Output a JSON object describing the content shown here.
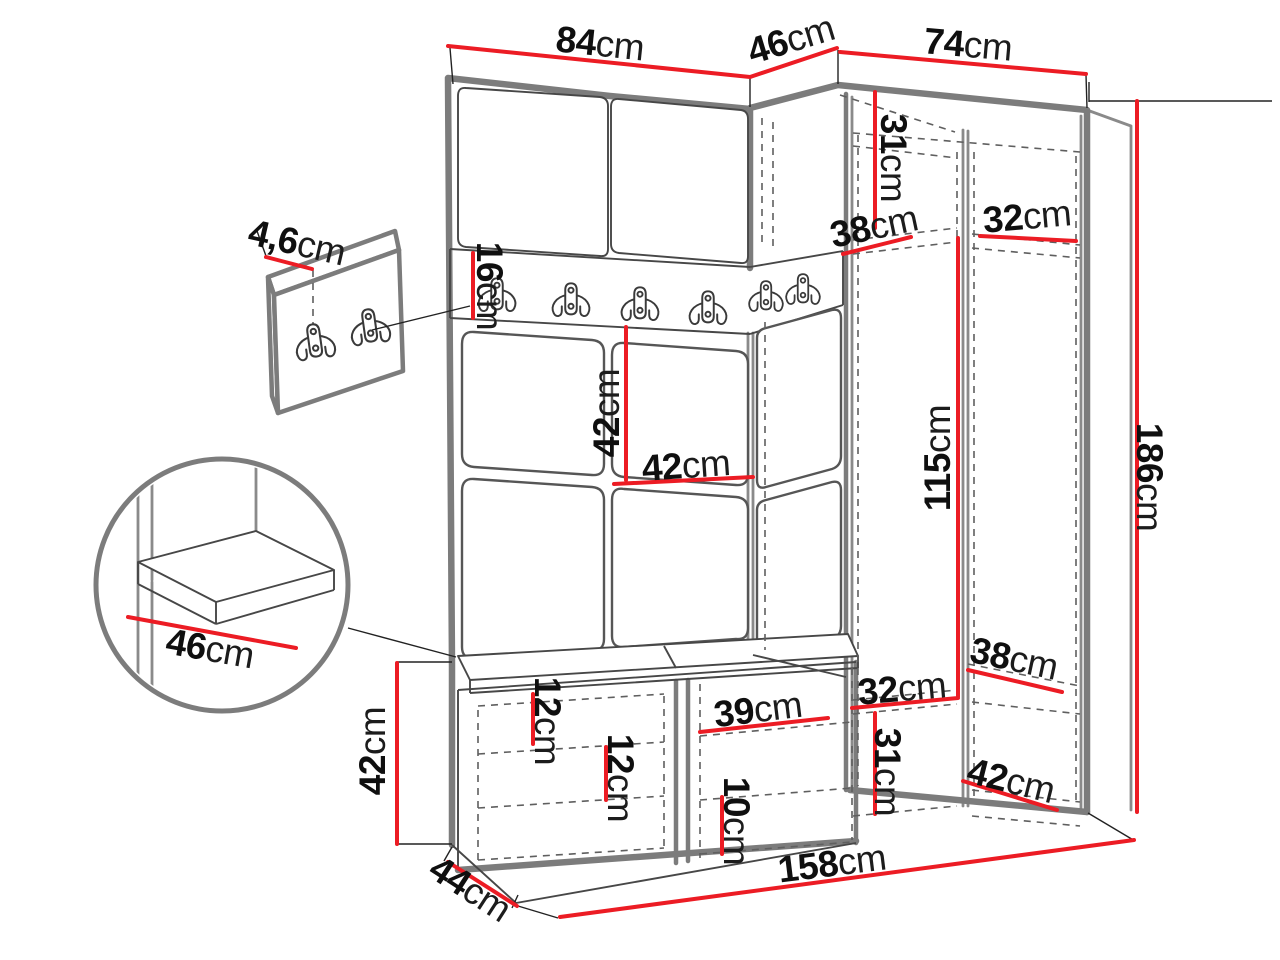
{
  "figure": {
    "type": "furniture-dimension-diagram",
    "subject": "hallway wardrobe set with coat hooks, corner wardrobe and shoe bench",
    "measurement_unit": "cm"
  },
  "colors": {
    "dimension_line": "#ec1c24",
    "outline_grey": "#7c7c7c",
    "text": "#0f0f0f",
    "background": "#ffffff"
  },
  "labels": [
    {
      "id": "top-width-left",
      "value": "84",
      "unit": "cm"
    },
    {
      "id": "top-width-corner",
      "value": "46",
      "unit": "cm"
    },
    {
      "id": "top-width-right",
      "value": "74",
      "unit": "cm"
    },
    {
      "id": "upper-compartment-height",
      "value": "31",
      "unit": "cm"
    },
    {
      "id": "upper-shelf-depth",
      "value": "38",
      "unit": "cm"
    },
    {
      "id": "upper-shelf-width-right",
      "value": "32",
      "unit": "cm"
    },
    {
      "id": "hook-rail-height",
      "value": "16",
      "unit": "cm"
    },
    {
      "id": "wall-panel-thickness",
      "value": "4,6",
      "unit": "cm"
    },
    {
      "id": "back-panel-height",
      "value": "42",
      "unit": "cm"
    },
    {
      "id": "back-panel-width",
      "value": "42",
      "unit": "cm"
    },
    {
      "id": "hanging-space-height",
      "value": "115",
      "unit": "cm"
    },
    {
      "id": "total-height",
      "value": "186",
      "unit": "cm"
    },
    {
      "id": "seat-depth-detail",
      "value": "46",
      "unit": "cm"
    },
    {
      "id": "lower-shelf-width-left",
      "value": "32",
      "unit": "cm"
    },
    {
      "id": "lower-shelf-depth",
      "value": "38",
      "unit": "cm"
    },
    {
      "id": "bench-height",
      "value": "42",
      "unit": "cm"
    },
    {
      "id": "bench-shelf-gap-a",
      "value": "12",
      "unit": "cm"
    },
    {
      "id": "bench-compartment-width",
      "value": "39",
      "unit": "cm"
    },
    {
      "id": "bench-shelf-gap-b",
      "value": "12",
      "unit": "cm"
    },
    {
      "id": "lower-compartment-height",
      "value": "31",
      "unit": "cm"
    },
    {
      "id": "bench-shelf-height",
      "value": "10",
      "unit": "cm"
    },
    {
      "id": "lower-shelf-width-right",
      "value": "42",
      "unit": "cm"
    },
    {
      "id": "bench-depth",
      "value": "44",
      "unit": "cm"
    },
    {
      "id": "total-width",
      "value": "158",
      "unit": "cm"
    }
  ]
}
